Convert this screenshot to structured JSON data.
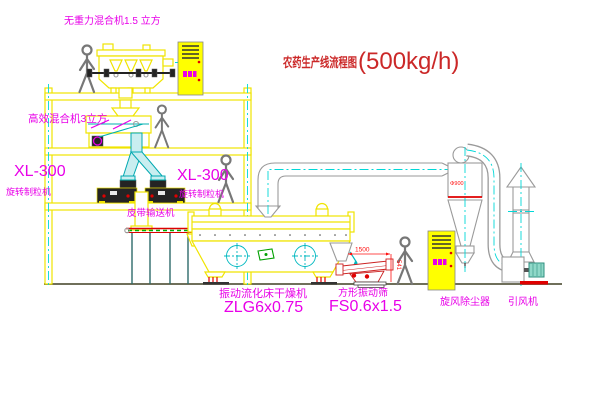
{
  "diagram": {
    "title": "农药生产线流程图",
    "title_capacity": "(500kg/h)"
  },
  "equipment": {
    "top_mixer": "无重力混合机1.5 立方",
    "floor_mixer": "高效混合机3立方",
    "granulator_left": {
      "model": "XL-300",
      "name": "旋转制粒机"
    },
    "granulator_right": {
      "model": "XL-300",
      "name": "旋转制粒机"
    },
    "belt_conveyor": "皮带输送机",
    "fluid_bed_dryer": {
      "name": "振动流化床干燥机",
      "model": "ZLG6x0.75"
    },
    "vibrating_sieve": {
      "name": "方形振动筛",
      "model": "FS0.6x1.5"
    },
    "cyclone": "旋风除尘器",
    "induced_draft_fan": "引风机"
  },
  "dimensions": {
    "sieve_length": "1500",
    "sieve_height": "541",
    "cyclone_note": "Φ900"
  },
  "colors": {
    "label_magenta": "#e800e8",
    "title_red": "#cb2828",
    "line_yellow": "#f0e400",
    "centerline_cyan": "#00d8d8",
    "dim_red": "#ff1010"
  }
}
